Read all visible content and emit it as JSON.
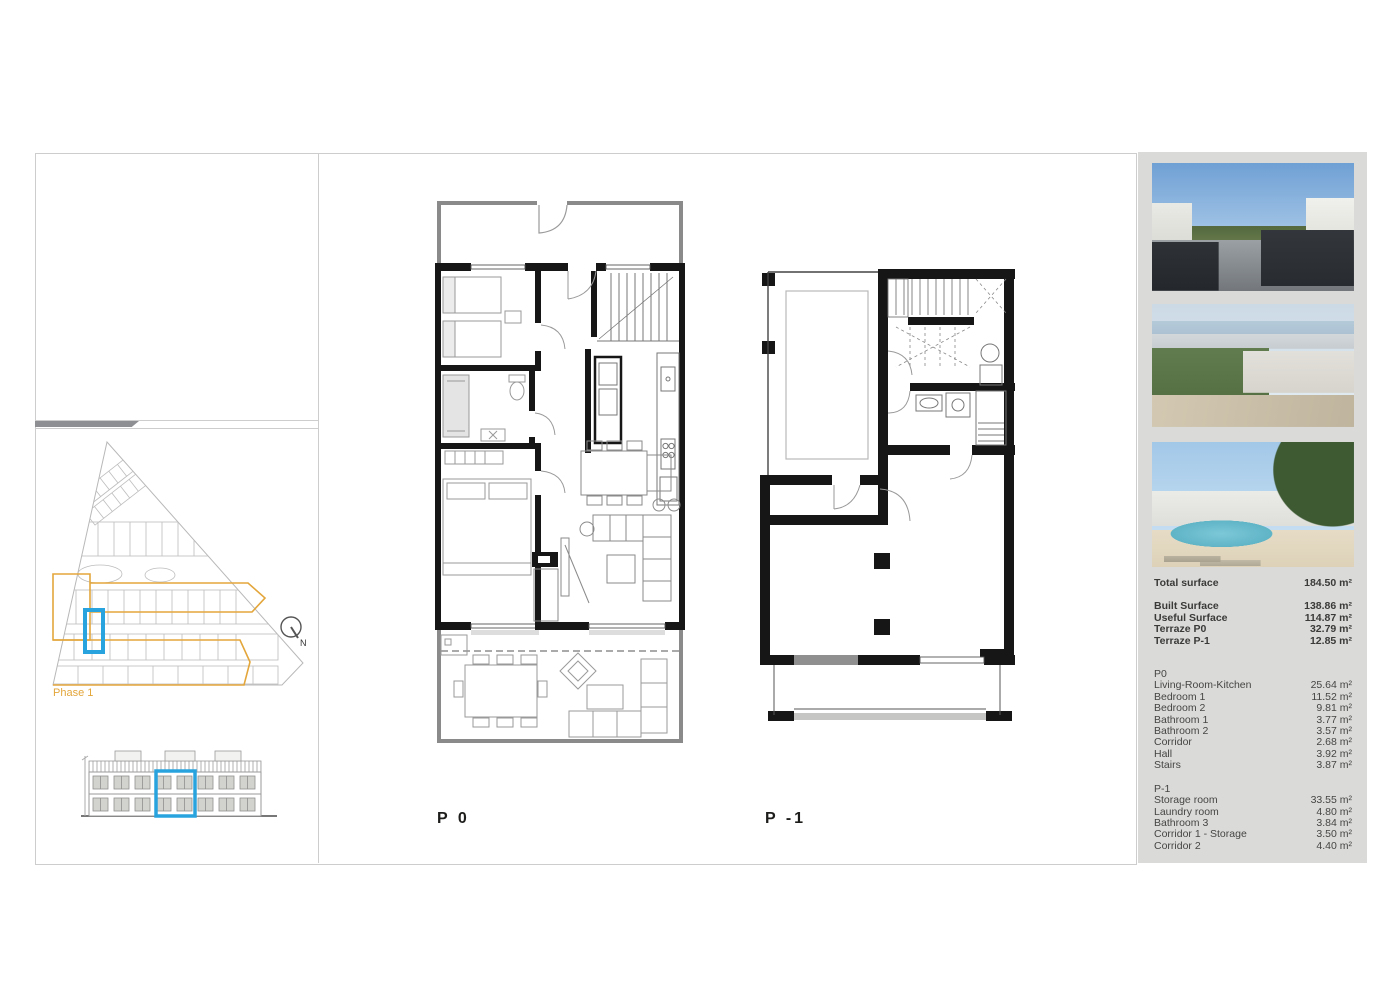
{
  "plan_labels": {
    "p0": "P 0",
    "p1": "P -1"
  },
  "site_plan": {
    "phase": "Phase 1",
    "north": "N"
  },
  "colors": {
    "accent_blue": "#29a3dd",
    "accent_orange": "#e3a63b",
    "sidebar_bg": "#dadad8"
  },
  "sidebar": {
    "photos": [
      {
        "name": "terrace-sea-view"
      },
      {
        "name": "aerial-coastline"
      },
      {
        "name": "residences-pool"
      }
    ],
    "totals": [
      {
        "label": "Total surface",
        "value": "184.50 m²"
      }
    ],
    "surfaces": [
      {
        "label": "Built Surface",
        "value": "138.86 m²"
      },
      {
        "label": "Useful Surface",
        "value": "114.87 m²"
      },
      {
        "label": "Terraze P0",
        "value": "32.79 m²"
      },
      {
        "label": "Terraze P-1",
        "value": "12.85 m²"
      }
    ],
    "p0_section": {
      "header": "P0",
      "rows": [
        {
          "label": "Living-Room-Kitchen",
          "value": "25.64 m²"
        },
        {
          "label": "Bedroom 1",
          "value": "11.52 m²"
        },
        {
          "label": "Bedroom 2",
          "value": "9.81 m²"
        },
        {
          "label": "Bathroom 1",
          "value": "3.77 m²"
        },
        {
          "label": "Bathroom 2",
          "value": "3.57 m²"
        },
        {
          "label": "Corridor",
          "value": "2.68 m²"
        },
        {
          "label": "Hall",
          "value": "3.92 m²"
        },
        {
          "label": "Stairs",
          "value": "3.87 m²"
        }
      ]
    },
    "p1_section": {
      "header": "P-1",
      "rows": [
        {
          "label": "Storage room",
          "value": "33.55 m²"
        },
        {
          "label": "Laundry room",
          "value": "4.80 m²"
        },
        {
          "label": "Bathroom 3",
          "value": "3.84 m²"
        },
        {
          "label": "Corridor 1 - Storage",
          "value": "3.50 m²"
        },
        {
          "label": "Corridor 2",
          "value": "4.40 m²"
        }
      ]
    }
  }
}
